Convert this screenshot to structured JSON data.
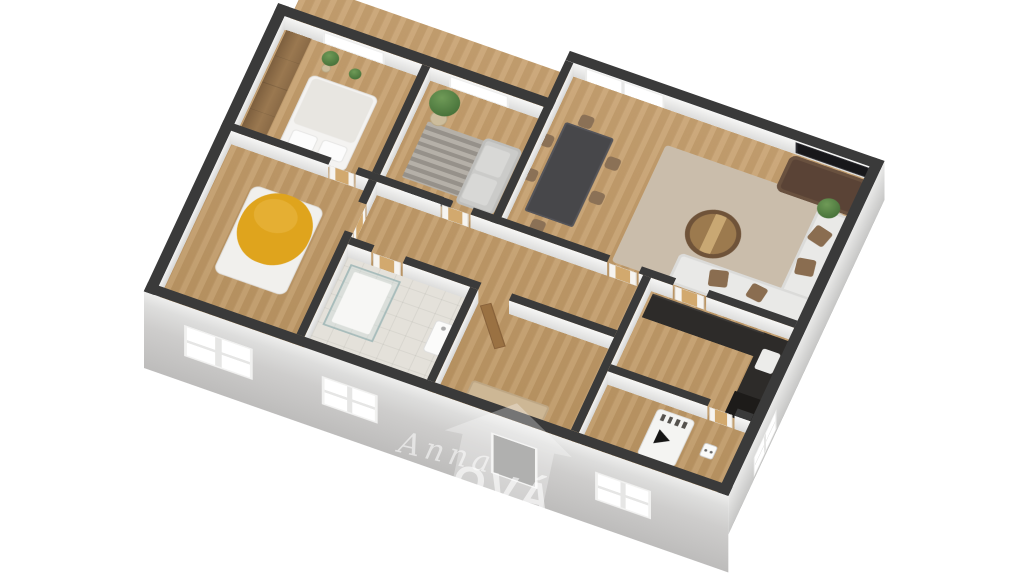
{
  "scene": {
    "type": "3d-floor-plan-render",
    "view": "isometric-top-down",
    "background": "#ffffff",
    "rooms": [
      {
        "name": "bedroom-main",
        "furniture": [
          "wood-wardrobe",
          "double-bed-white",
          "plants",
          "balcony-door"
        ]
      },
      {
        "name": "small-room",
        "furniture": [
          "tall-plant",
          "striped-rug",
          "gray-sofa",
          "media-bench",
          "window"
        ]
      },
      {
        "name": "living-room",
        "furniture": [
          "french-door",
          "dining-table-dark",
          "six-chairs",
          "wall-tv",
          "brown-sofa",
          "white-corner-sofa",
          "round-coffee-table",
          "beige-rug",
          "plant"
        ]
      },
      {
        "name": "bedroom-yellow",
        "furniture": [
          "bed-yellow-blanket",
          "south-window"
        ]
      },
      {
        "name": "bathroom",
        "furniture": [
          "glass-shower",
          "washbasin"
        ]
      },
      {
        "name": "hallway",
        "furniture": [
          "interior-doors"
        ]
      },
      {
        "name": "entry",
        "furniture": [
          "beige-bench",
          "open-wood-door"
        ]
      },
      {
        "name": "kitchen",
        "furniture": [
          "dark-counter-north",
          "dark-counter-east",
          "sink",
          "tall-dark-unit"
        ]
      },
      {
        "name": "utility-room",
        "furniture": [
          "boiler-white",
          "wall-socket-box"
        ]
      }
    ]
  },
  "palette": {
    "wall_top": "#3a3a3a",
    "interior_face": "#efefee",
    "exterior_face": "#d2d2d1",
    "wood_floor": "#c49e6c",
    "tile_floor": "#e4e1da",
    "rug_living": "#cabdab",
    "counter_dark": "#2d2b29",
    "bed_yellow": "#dfa41d",
    "sofa_brown": "#5a4336",
    "background": "#ffffff"
  },
  "watermark": {
    "script_text": "Anna",
    "caps_text": "OVÁ"
  }
}
